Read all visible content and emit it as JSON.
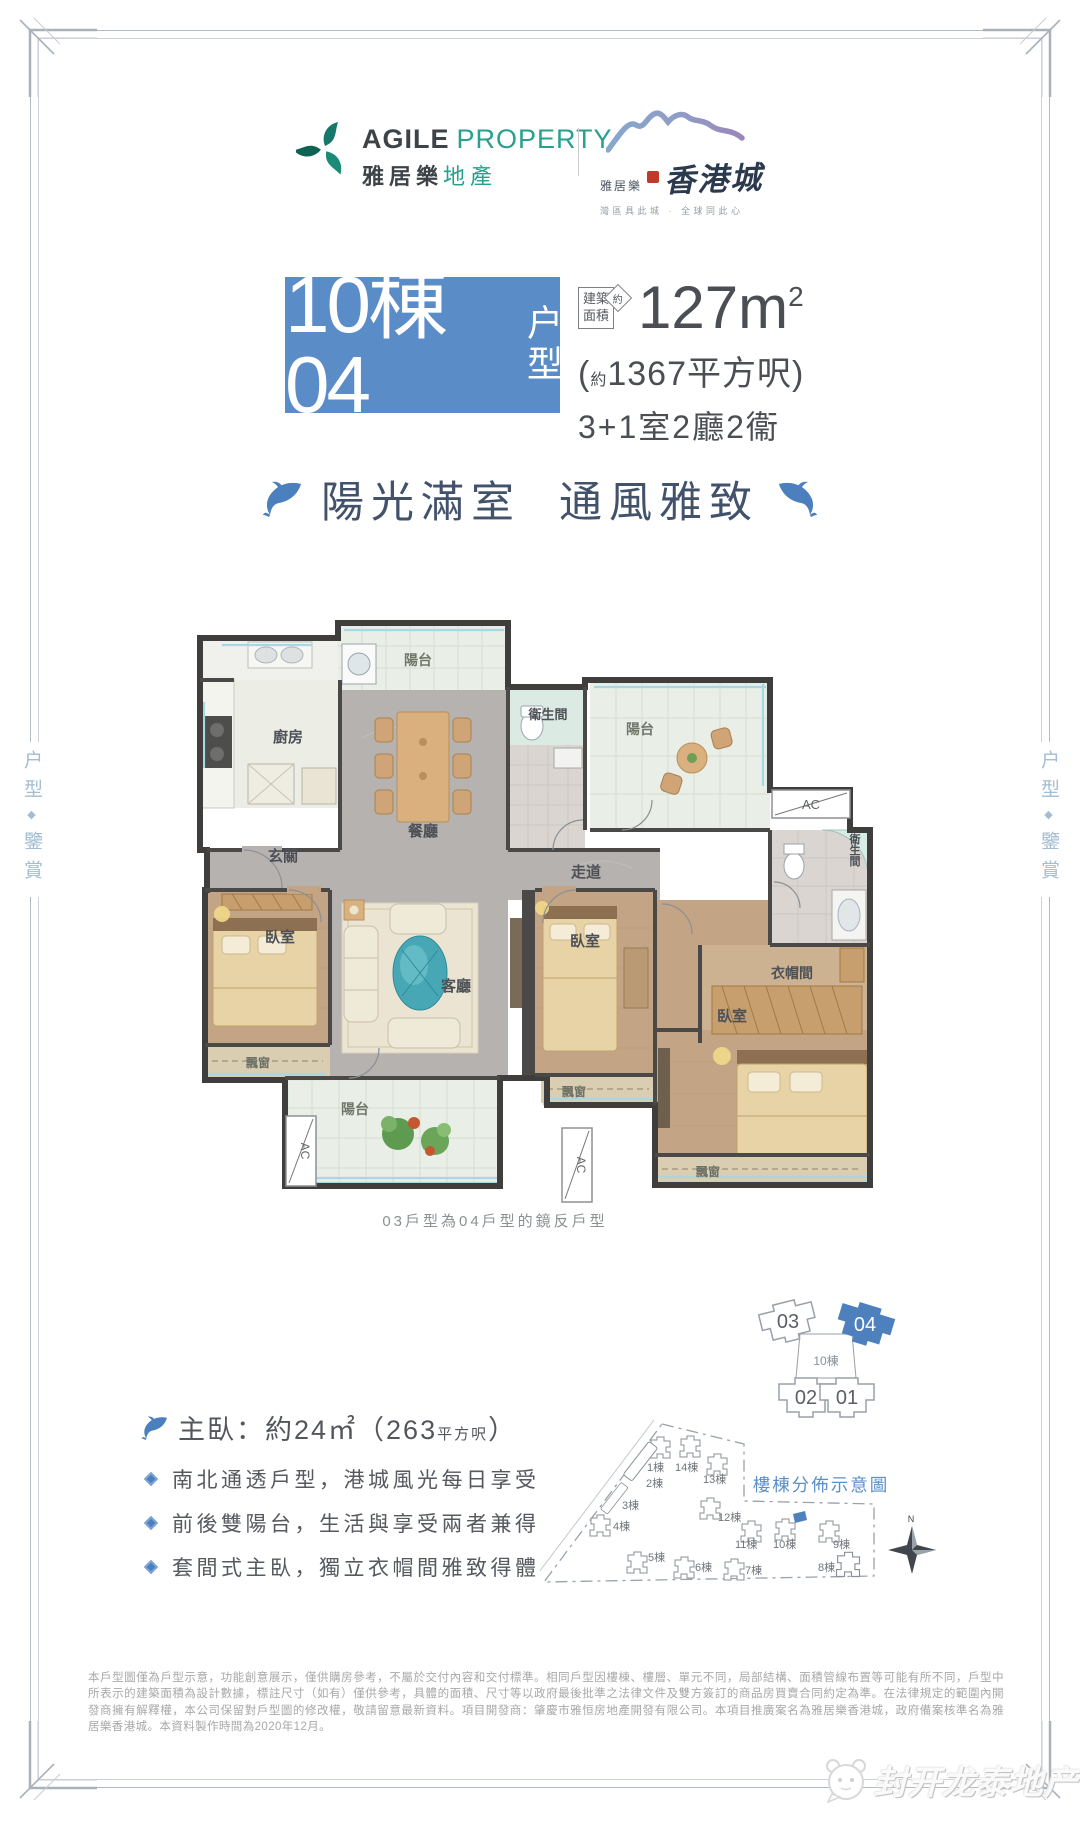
{
  "header": {
    "agile_en_bold": "AGILE",
    "agile_en_light": "PROPERTY",
    "agile_cn_bold": "雅居樂",
    "agile_cn_light": "地產",
    "hkc_prefix": "雅居樂",
    "hkc_name": "香港城",
    "hkc_slogan": "灣區具此城 · 全球同此心"
  },
  "side_label": {
    "top": "户型",
    "diamond": "◆",
    "bottom": "鑒賞"
  },
  "title_block": {
    "unit_code": "10棟04",
    "unit_suffix": "户型",
    "area_badge_line1": "建築",
    "area_badge_line2": "面積",
    "area_approx": "約",
    "area_value": "127m",
    "area_sup": "2",
    "area_hk_open": "(",
    "area_hk_approx": "約",
    "area_hk_rest": "1367平方呎)",
    "layout_text": "3+1室2廳2衞"
  },
  "tagline": {
    "text": "陽光滿室  通風雅致"
  },
  "floor_plan": {
    "rooms": {
      "balcony": "陽台",
      "kitchen": "廚房",
      "bathroom": "衛生間",
      "dining": "餐廳",
      "entry": "玄關",
      "hallway": "走道",
      "bedroom": "臥室",
      "living": "客廳",
      "closet": "衣帽間",
      "bay_window": "飄窗",
      "ac": "AC"
    },
    "caption": "03戶型為04戶型的鏡反戶型"
  },
  "unit_key": {
    "block_label": "10棟",
    "units": [
      {
        "id": "03"
      },
      {
        "id": "04"
      },
      {
        "id": "02"
      },
      {
        "id": "01"
      }
    ]
  },
  "master_info": {
    "prefix": "主臥：約24㎡（263",
    "unit_small": "平方呎",
    "suffix": "）"
  },
  "features": [
    "南北通透戶型，港城風光每日享受",
    "前後雙陽台，生活與享受兩者兼得",
    "套間式主臥，獨立衣帽間雅致得體"
  ],
  "site_plan": {
    "title": "樓棟分佈示意圖",
    "compass": "N",
    "buildings": [
      "1棟",
      "2棟",
      "3棟",
      "4棟",
      "5棟",
      "6棟",
      "7棟",
      "8棟",
      "9棟",
      "10棟",
      "11棟",
      "12棟",
      "13棟",
      "14棟"
    ]
  },
  "disclaimer": "本戶型圖僅為戶型示意，功能創意展示，僅供購房參考，不屬於交付內容和交付標準。相同戶型因樓棟、樓層、單元不同，局部結構、面積管線布置等可能有所不同，戶型中所表示的建築面積為設計數據，標註尺寸（如有）僅供參考，具體的面積、尺寸等以政府最後批準之法律文件及雙方簽訂的商品房買賣合同約定為準。在法律規定的範圍內開發商擁有解釋權，本公司保留對戶型圖的修改權，敬請留意最新資料。項目開發商：肇慶市雅恒房地產開發有限公司。本項目推廣案名為雅居樂香港城，政府備案核準名為雅居樂香港城。本資料製作時間為2020年12月。",
  "watermark": {
    "text": "封开龙泰地产"
  },
  "colors": {
    "accent_blue": "#5a8cc7",
    "brand_teal": "#27a08e",
    "highlight_unit": "#4d80bd"
  }
}
